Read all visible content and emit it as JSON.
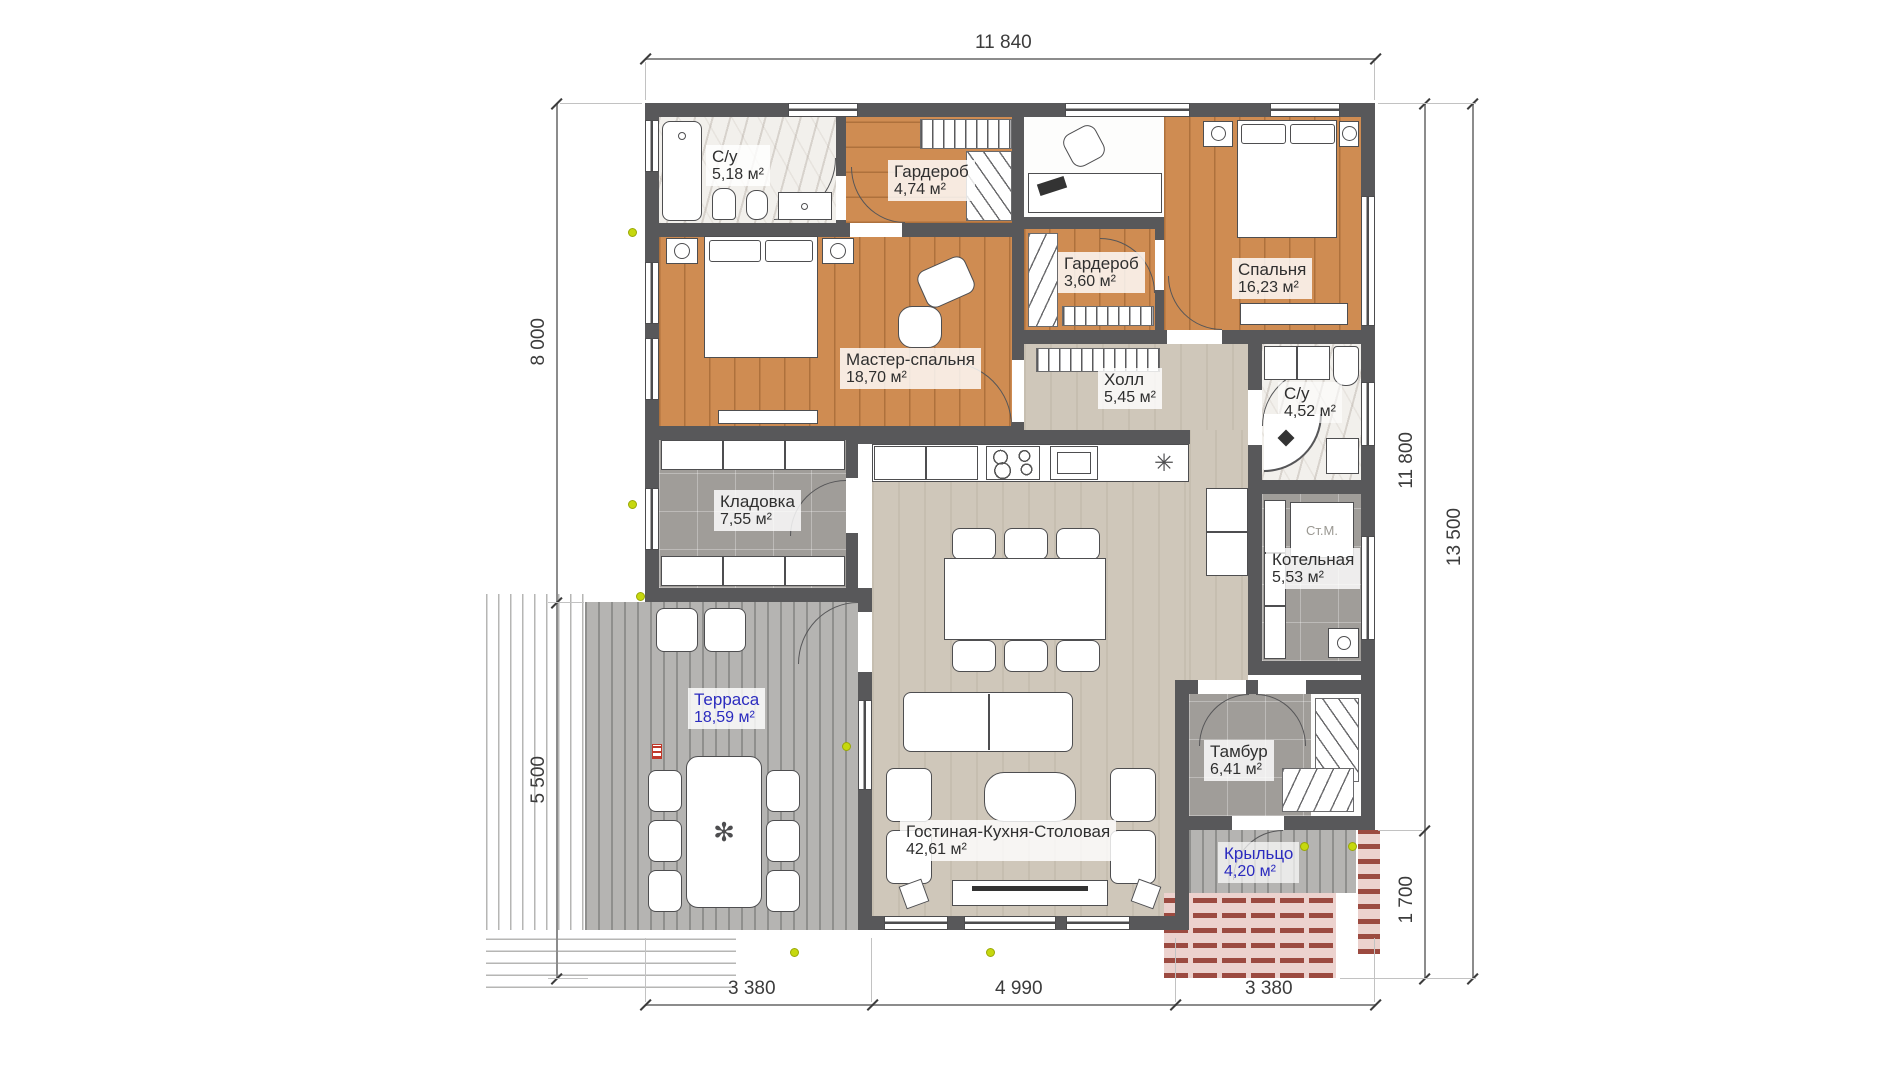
{
  "rooms": [
    {
      "name": "С/у",
      "area": "5,18 м²"
    },
    {
      "name": "Гардероб",
      "area": "4,74 м²"
    },
    {
      "name": "Спальня",
      "area": "16,23 м²"
    },
    {
      "name": "Гардероб",
      "area": "3,60 м²"
    },
    {
      "name": "Мастер-спальня",
      "area": "18,70 м²"
    },
    {
      "name": "Холл",
      "area": "5,45 м²"
    },
    {
      "name": "С/у",
      "area": "4,52 м²"
    },
    {
      "name": "Кладовка",
      "area": "7,55 м²"
    },
    {
      "name": "Котельная",
      "area": "5,53 м²"
    },
    {
      "name": "Терраса",
      "area": "18,59 м²"
    },
    {
      "name": "Гостиная-Кухня-Столовая",
      "area": "42,61 м²"
    },
    {
      "name": "Тамбур",
      "area": "6,41 м²"
    },
    {
      "name": "Крыльцо",
      "area": "4,20 м²"
    }
  ],
  "appliances": {
    "washer": "Ст.М."
  },
  "icons": {
    "sink": "✳",
    "fan": "✻"
  },
  "dimensions": {
    "top": "11 840",
    "left_upper": "8 000",
    "left_lower": "5 500",
    "right_inner": "11 800",
    "right_outer": "13 500",
    "right_porch": "1 700",
    "bottom_left": "3 380",
    "bottom_center": "4 990",
    "bottom_right": "3 380"
  },
  "colors": {
    "wall": "#58585a",
    "wood": "#cf8c52",
    "accent_label": "#2b2bbf",
    "marker": "#c6d80e"
  }
}
